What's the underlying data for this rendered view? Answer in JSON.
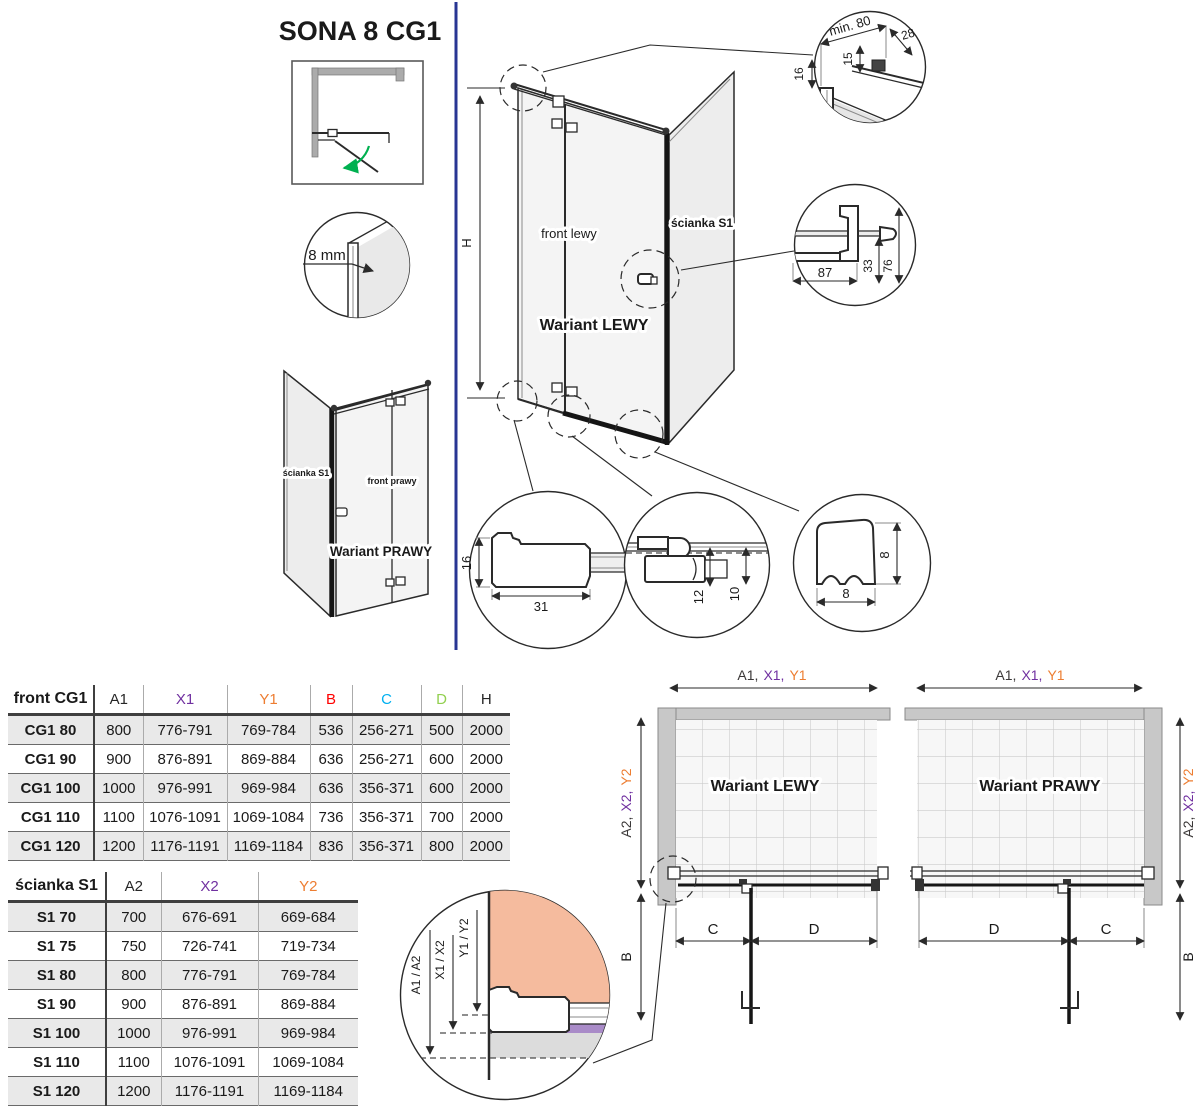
{
  "title": "SONA 8 CG1",
  "colors": {
    "dim_a": "#3B3838",
    "dim_x": "#7030A0",
    "dim_y": "#ED7D31",
    "dim_b": "#FF0000",
    "dim_c": "#00B0F0",
    "dim_d": "#92D050",
    "divider_line": "#283593",
    "swing_arrow": "#00B050",
    "detail_salmon": "#F5BB9E",
    "detail_purple": "#A98BC8",
    "detail_gray": "#DCDCDC"
  },
  "top_view": {
    "glass_label": "8 mm"
  },
  "variant_left": {
    "caption": "Wariant LEWY",
    "front_label": "front lewy",
    "wall_label": "ścianka S1",
    "height_label": "H"
  },
  "variant_right": {
    "caption": "Wariant PRAWY",
    "front_label": "front prawy",
    "wall_label": "ścianka S1"
  },
  "detail_top_bar": {
    "min_width": "min. 80",
    "d28": "28",
    "d15": "15",
    "d16": "16"
  },
  "detail_handle": {
    "d87": "87",
    "d33": "33",
    "d76": "76"
  },
  "detail_wall_profile": {
    "d16": "16",
    "d31": "31"
  },
  "detail_hinge": {
    "d12": "12",
    "d10": "10"
  },
  "detail_seal": {
    "height": "8",
    "width": "8"
  },
  "detail_adjust": {
    "a": "A1 / A2",
    "x": "X1 / X2",
    "y": "Y1 / Y2"
  },
  "front_table": {
    "title": "front CG1",
    "columns": [
      "A1",
      "X1",
      "Y1",
      "B",
      "C",
      "D",
      "H"
    ],
    "rows": [
      {
        "name": "CG1 80",
        "a1": "800",
        "x1": "776-791",
        "y1": "769-784",
        "b": "536",
        "c": "256-271",
        "d": "500",
        "h": "2000"
      },
      {
        "name": "CG1 90",
        "a1": "900",
        "x1": "876-891",
        "y1": "869-884",
        "b": "636",
        "c": "256-271",
        "d": "600",
        "h": "2000"
      },
      {
        "name": "CG1 100",
        "a1": "1000",
        "x1": "976-991",
        "y1": "969-984",
        "b": "636",
        "c": "356-371",
        "d": "600",
        "h": "2000"
      },
      {
        "name": "CG1 110",
        "a1": "1100",
        "x1": "1076-1091",
        "y1": "1069-1084",
        "b": "736",
        "c": "356-371",
        "d": "700",
        "h": "2000"
      },
      {
        "name": "CG1 120",
        "a1": "1200",
        "x1": "1176-1191",
        "y1": "1169-1184",
        "b": "836",
        "c": "356-371",
        "d": "800",
        "h": "2000"
      }
    ]
  },
  "wall_table": {
    "title": "ścianka S1",
    "columns": [
      "A2",
      "X2",
      "Y2"
    ],
    "rows": [
      {
        "name": "S1 70",
        "a2": "700",
        "x2": "676-691",
        "y2": "669-684"
      },
      {
        "name": "S1 75",
        "a2": "750",
        "x2": "726-741",
        "y2": "719-734"
      },
      {
        "name": "S1 80",
        "a2": "800",
        "x2": "776-791",
        "y2": "769-784"
      },
      {
        "name": "S1 90",
        "a2": "900",
        "x2": "876-891",
        "y2": "869-884"
      },
      {
        "name": "S1 100",
        "a2": "1000",
        "x2": "976-991",
        "y2": "969-984"
      },
      {
        "name": "S1 110",
        "a2": "1100",
        "x2": "1076-1091",
        "y2": "1069-1084"
      },
      {
        "name": "S1 120",
        "a2": "1200",
        "x2": "1176-1191",
        "y2": "1169-1184"
      }
    ]
  },
  "plan_left": {
    "caption": "Wariant LEWY",
    "top_dim": {
      "a": "A1,",
      "x": "X1,",
      "y": "Y1"
    },
    "side_dim": {
      "a": "A2,",
      "x": "X2,",
      "y": "Y2"
    },
    "b": "B",
    "c": "C",
    "d": "D"
  },
  "plan_right": {
    "caption": "Wariant PRAWY",
    "top_dim": {
      "a": "A1,",
      "x": "X1,",
      "y": "Y1"
    },
    "side_dim": {
      "a": "A2,",
      "x": "X2,",
      "y": "Y2"
    },
    "b": "B",
    "c": "C",
    "d": "D"
  }
}
